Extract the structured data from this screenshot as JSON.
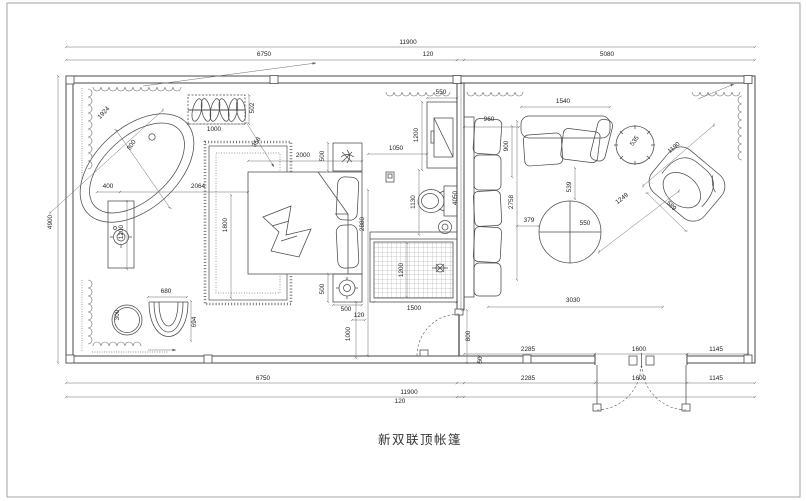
{
  "title": "新双联顶帐篷",
  "dim_labels": [
    {
      "t": "11900",
      "x": 408,
      "y": 44,
      "r": 0
    },
    {
      "t": "6750",
      "x": 264,
      "y": 56,
      "r": 0
    },
    {
      "t": "120",
      "x": 428,
      "y": 56,
      "r": 0
    },
    {
      "t": "5080",
      "x": 607,
      "y": 56,
      "r": 0
    },
    {
      "t": "4900",
      "x": 52,
      "y": 222,
      "r": -90
    },
    {
      "t": "2285",
      "x": 528,
      "y": 351,
      "r": 0
    },
    {
      "t": "1600",
      "x": 639,
      "y": 351,
      "r": 0
    },
    {
      "t": "1145",
      "x": 716,
      "y": 351,
      "r": 0
    },
    {
      "t": "6750",
      "x": 263,
      "y": 380,
      "r": 0
    },
    {
      "t": "2285",
      "x": 528,
      "y": 380,
      "r": 0
    },
    {
      "t": "1600",
      "x": 639,
      "y": 380,
      "r": 0
    },
    {
      "t": "1145",
      "x": 716,
      "y": 380,
      "r": 0
    },
    {
      "t": "11900",
      "x": 409,
      "y": 394,
      "r": 0
    },
    {
      "t": "120",
      "x": 400,
      "y": 403,
      "r": 0
    },
    {
      "t": "1924",
      "x": 105,
      "y": 114,
      "r": -47
    },
    {
      "t": "800",
      "x": 133,
      "y": 146,
      "r": -56
    },
    {
      "t": "1000",
      "x": 214,
      "y": 131,
      "r": 0
    },
    {
      "t": "502",
      "x": 254,
      "y": 108,
      "r": -90
    },
    {
      "t": "358",
      "x": 258,
      "y": 143,
      "r": -58
    },
    {
      "t": "400",
      "x": 108,
      "y": 188,
      "r": 0
    },
    {
      "t": "2064",
      "x": 198,
      "y": 188,
      "r": 0
    },
    {
      "t": "1200",
      "x": 123,
      "y": 232,
      "r": -90
    },
    {
      "t": "300",
      "x": 119,
      "y": 315,
      "r": -90
    },
    {
      "t": "680",
      "x": 166,
      "y": 293,
      "r": 0
    },
    {
      "t": "694",
      "x": 196,
      "y": 322,
      "r": -90
    },
    {
      "t": "1800",
      "x": 227,
      "y": 225,
      "r": -90
    },
    {
      "t": "2000",
      "x": 303,
      "y": 157,
      "r": 0
    },
    {
      "t": "500",
      "x": 324,
      "y": 156,
      "r": -90
    },
    {
      "t": "500",
      "x": 324,
      "y": 289,
      "r": -90
    },
    {
      "t": "500",
      "x": 346,
      "y": 311,
      "r": 0
    },
    {
      "t": "2880",
      "x": 364,
      "y": 224,
      "r": -90
    },
    {
      "t": "550",
      "x": 441,
      "y": 94,
      "r": 0
    },
    {
      "t": "1200",
      "x": 418,
      "y": 135,
      "r": -90
    },
    {
      "t": "1050",
      "x": 396,
      "y": 150,
      "r": 0
    },
    {
      "t": "1130",
      "x": 415,
      "y": 202,
      "r": -90
    },
    {
      "t": "1200",
      "x": 403,
      "y": 270,
      "r": -90
    },
    {
      "t": "1500",
      "x": 414,
      "y": 310,
      "r": 0
    },
    {
      "t": "120",
      "x": 359,
      "y": 317,
      "r": 0
    },
    {
      "t": "1000",
      "x": 350,
      "y": 334,
      "r": -90
    },
    {
      "t": "800",
      "x": 470,
      "y": 336,
      "r": -90
    },
    {
      "t": "50",
      "x": 482,
      "y": 360,
      "r": -90
    },
    {
      "t": "960",
      "x": 489,
      "y": 121,
      "r": 0
    },
    {
      "t": "900",
      "x": 508,
      "y": 146,
      "r": -90
    },
    {
      "t": "4050",
      "x": 457,
      "y": 198,
      "r": -90
    },
    {
      "t": "2758",
      "x": 513,
      "y": 202,
      "r": -90
    },
    {
      "t": "1540",
      "x": 563,
      "y": 103,
      "r": 0
    },
    {
      "t": "539",
      "x": 571,
      "y": 187,
      "r": -90
    },
    {
      "t": "379",
      "x": 529,
      "y": 222,
      "r": 0
    },
    {
      "t": "550",
      "x": 585,
      "y": 225,
      "r": 0
    },
    {
      "t": "535",
      "x": 636,
      "y": 142,
      "r": -54
    },
    {
      "t": "1190",
      "x": 675,
      "y": 149,
      "r": -40
    },
    {
      "t": "1249",
      "x": 623,
      "y": 200,
      "r": -38
    },
    {
      "t": "589",
      "x": 670,
      "y": 207,
      "r": 46
    },
    {
      "t": "3030",
      "x": 573,
      "y": 302,
      "r": 0
    }
  ]
}
